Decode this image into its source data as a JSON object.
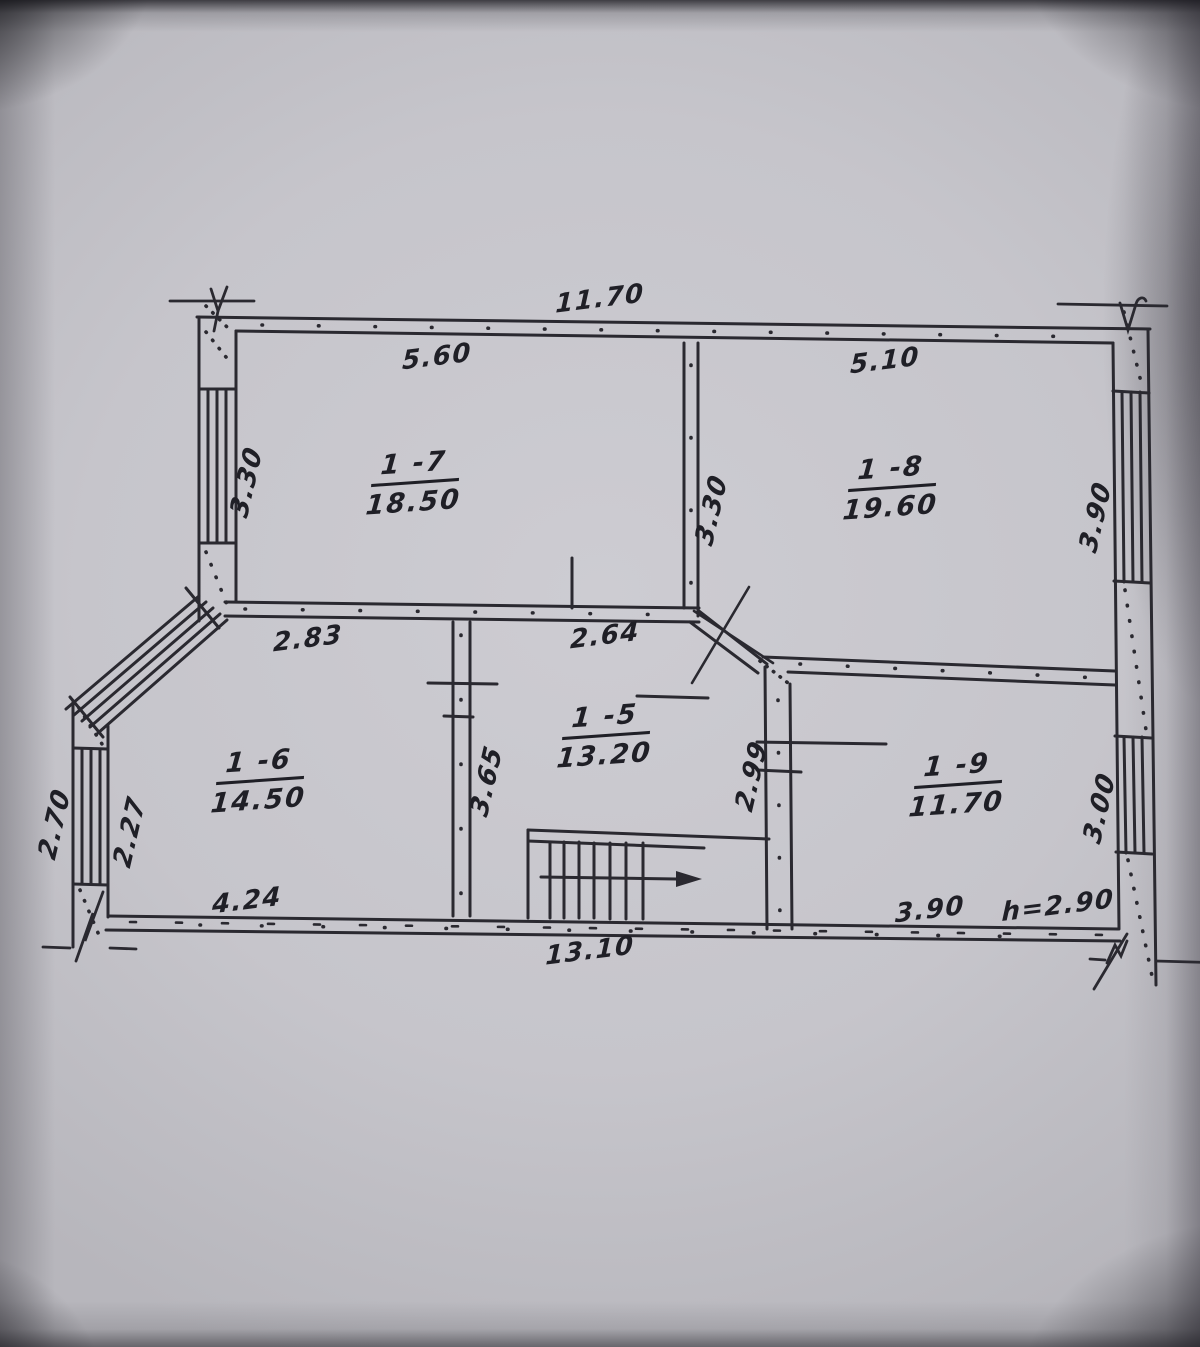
{
  "document": {
    "type": "scanned hand-drawn floor plan",
    "colors": {
      "ink": "#2a2930",
      "paper": "#c9c8ce"
    }
  },
  "rooms": [
    {
      "number": "1 -7",
      "area": "18.50"
    },
    {
      "number": "1 -8",
      "area": "19.60"
    },
    {
      "number": "1 -6",
      "area": "14.50"
    },
    {
      "number": "1 -5",
      "area": "13.20"
    },
    {
      "number": "1 -9",
      "area": "11.70"
    }
  ],
  "dimensions": {
    "top_overall": "11.70",
    "top_left_width": "5.60",
    "top_right_width": "5.10",
    "left_height_1_7": "3.30",
    "middle_height": "3.30",
    "right_height_1_8": "3.90",
    "width_1_6_top": "2.83",
    "width_1_5_top": "2.64",
    "left_outer": "2.70",
    "left_inner": "2.27",
    "height_1_5": "3.65",
    "height_1_5_right": "2.99",
    "right_height_1_9": "3.00",
    "bottom_left_width": "4.24",
    "bottom_right_width": "3.90",
    "ceiling_height": "h=2.90",
    "bottom_overall": "13.10"
  }
}
